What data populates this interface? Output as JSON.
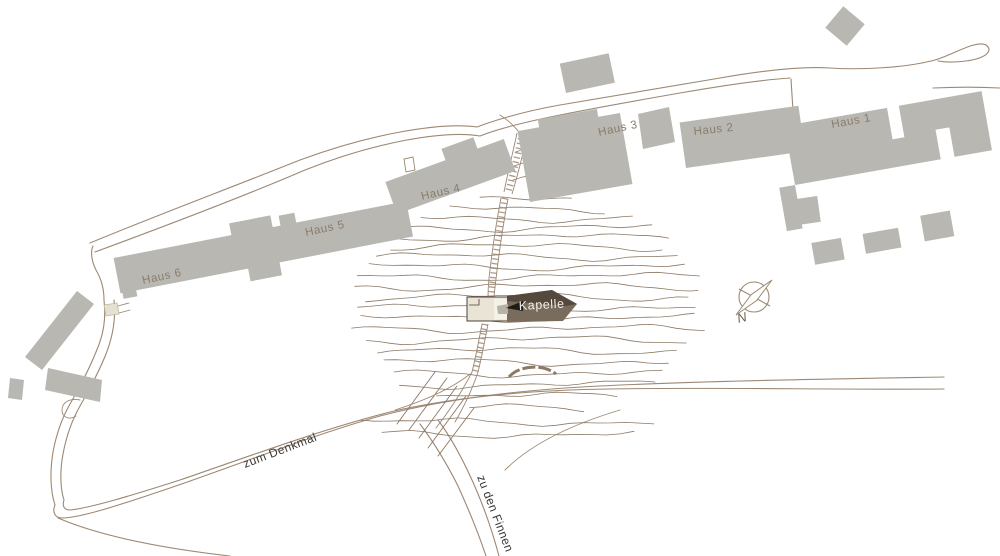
{
  "map": {
    "building_labels": {
      "haus1": "Haus 1",
      "haus2": "Haus 2",
      "haus3": "Haus 3",
      "haus4": "Haus 4",
      "haus5": "Haus 5",
      "haus6": "Haus 6"
    },
    "poi_labels": {
      "kapelle": "Kapelle"
    },
    "path_labels": {
      "denkmal": "zum Denkmal",
      "finnen": "zu den Finnen"
    },
    "compass": {
      "north": "N"
    },
    "colors": {
      "building": "#b8b7b2",
      "building_label": "#8b7c6a",
      "road": "#9c8874",
      "contour": "#8c7965",
      "path_label": "#3c3a37",
      "kapelle_light": "#e9e4d6",
      "kapelle_light2": "#f4f1e7",
      "kapelle_dark": "#7a6c5c",
      "kapelle_roof": "#55493d",
      "kapelle_black": "#201b15",
      "kapelle_gray": "#b9b2a4",
      "kapelle_text": "#f2efe8",
      "annex": "#e6e0d2",
      "annex_stroke": "#bdb2a0",
      "outline_dark": "#4a4038",
      "compass": "#9c8874",
      "n_label": "#6e6152"
    }
  }
}
